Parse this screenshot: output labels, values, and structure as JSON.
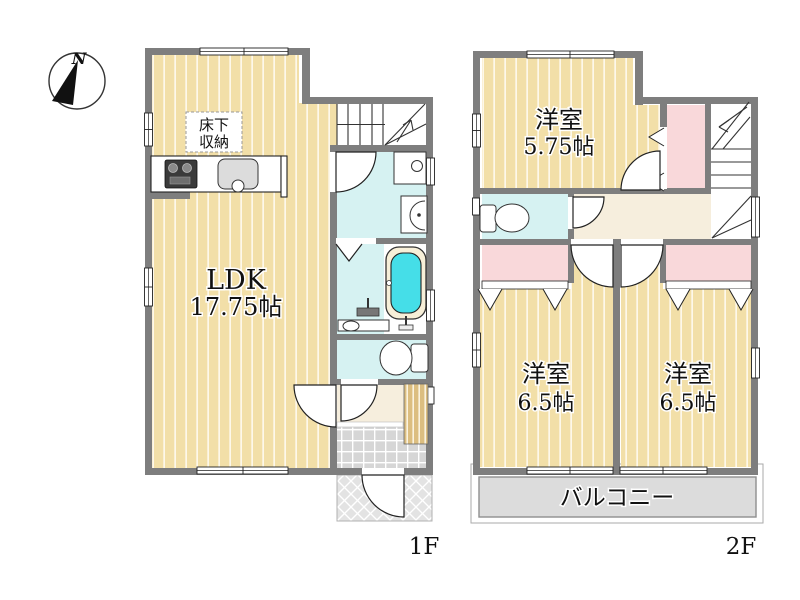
{
  "compass": {
    "north_label": "N"
  },
  "floor1": {
    "floor_label": "1F",
    "rooms": {
      "ldk": {
        "name": "LDK",
        "size": "17.75帖"
      },
      "floor_storage": {
        "line1": "床下",
        "line2": "収納"
      }
    },
    "fixtures": [
      "kitchen-counter",
      "gas-stove",
      "kitchen-sink",
      "staircase-up",
      "washing-machine-pan",
      "washbasin",
      "bathtub",
      "shower-faucet",
      "toilet",
      "shoe-cabinet",
      "entrance-tile",
      "porch"
    ]
  },
  "floor2": {
    "floor_label": "2F",
    "rooms": {
      "bedroom_top": {
        "name": "洋室",
        "size": "5.75帖"
      },
      "bedroom_left": {
        "name": "洋室",
        "size": "6.5帖"
      },
      "bedroom_right": {
        "name": "洋室",
        "size": "6.5帖"
      },
      "balcony": {
        "name": "バルコニー"
      }
    },
    "fixtures": [
      "staircase-down",
      "toilet",
      "closet",
      "closet",
      "closet"
    ]
  },
  "colors": {
    "wall": "#7e7e7e",
    "wood_floor": "#f2dfa8",
    "water_room": "#d6f2f2",
    "bath_water": "#45dee8",
    "closet_pink": "#f9d8da",
    "hall_cream": "#f6eedd",
    "balcony_gray": "#dcdcdc",
    "tile_gray": "#d6d6d6"
  }
}
